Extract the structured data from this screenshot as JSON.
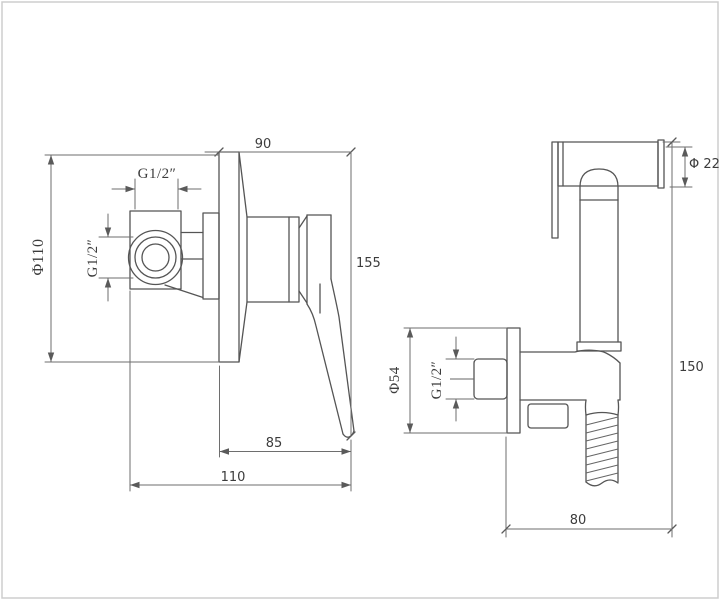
{
  "drawing": {
    "type": "technical dimension drawing",
    "views": {
      "left_view": {
        "name": "concealed shower mixer valve - side view",
        "dims": {
          "phi110": "Φ110",
          "g12_top": "G1/2″",
          "g12_side": "G1/2″",
          "width_90": "90",
          "height_155": "155",
          "depth_85": "85",
          "depth_110": "110"
        }
      },
      "right_view": {
        "name": "handheld bidet sprayer with wall outlet holder - side view",
        "dims": {
          "phi22": "Φ 22",
          "phi54": "Φ54",
          "g12": "G1/2″",
          "height_150": "150",
          "width_80": "80"
        }
      }
    },
    "colors": {
      "background": "#ffffff",
      "line": "#555555",
      "dimension_line": "#6e6e6e",
      "text": "#3c3c3c",
      "frame_border": "#cdcdcd"
    }
  }
}
